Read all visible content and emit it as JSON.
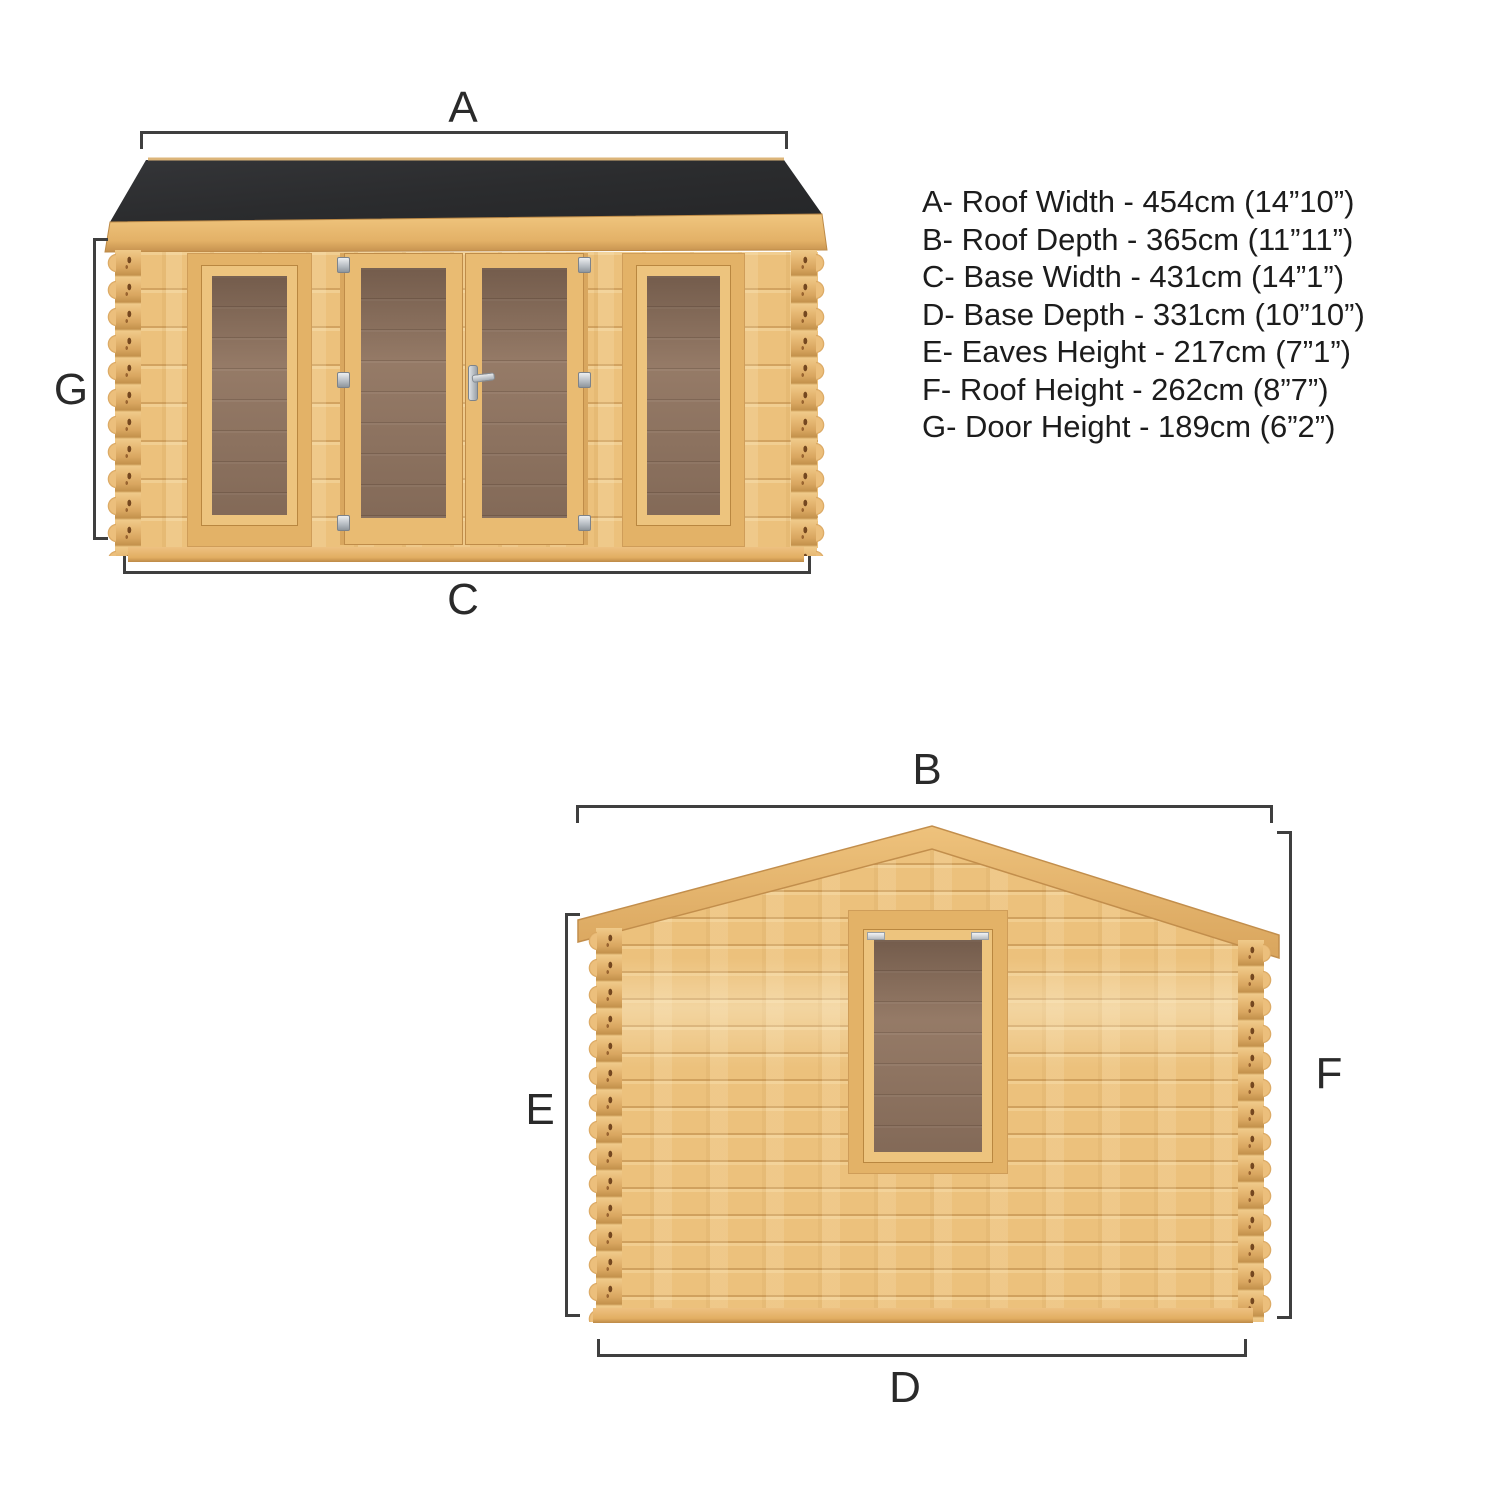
{
  "page": {
    "type": "product-dimension-diagram",
    "subject": "log cabin with double glazed doors, two front windows and gable-end side window"
  },
  "labels": {
    "a": "A",
    "b": "B",
    "c": "C",
    "d": "D",
    "e": "E",
    "f": "F",
    "g": "G"
  },
  "specs": [
    {
      "letter": "A",
      "name": "Roof Width",
      "value_cm": "454cm",
      "value_imperial": "14”10”",
      "text": "A- Roof Width - 454cm (14”10”)"
    },
    {
      "letter": "B",
      "name": "Roof Depth",
      "value_cm": "365cm",
      "value_imperial": "11”11”",
      "text": "B- Roof Depth - 365cm (11”11”)"
    },
    {
      "letter": "C",
      "name": "Base Width",
      "value_cm": "431cm",
      "value_imperial": "14”1”",
      "text": "C- Base Width - 431cm (14”1”)"
    },
    {
      "letter": "D",
      "name": "Base Depth",
      "value_cm": "331cm",
      "value_imperial": "10”10”",
      "text": "D- Base Depth - 331cm (10”10”)"
    },
    {
      "letter": "E",
      "name": "Eaves Height",
      "value_cm": "217cm",
      "value_imperial": "7”1”",
      "text": "E- Eaves Height - 217cm (7”1”)"
    },
    {
      "letter": "F",
      "name": "Roof Height",
      "value_cm": "262cm",
      "value_imperial": "8”7”",
      "text": "F- Roof Height - 262cm (8”7”)"
    },
    {
      "letter": "G",
      "name": "Door Height",
      "value_cm": "189cm",
      "value_imperial": "6”2”",
      "text": "G- Door Height - 189cm (6”2”)"
    }
  ],
  "colors": {
    "background": "#ffffff",
    "roof_felt": "#2c2d2f",
    "wood": "#ecc17c",
    "wood_trim": "#e7ba70",
    "glass": "#8e7462",
    "dimension_lines": "#3f3f3f",
    "text": "#1c1c1c"
  }
}
